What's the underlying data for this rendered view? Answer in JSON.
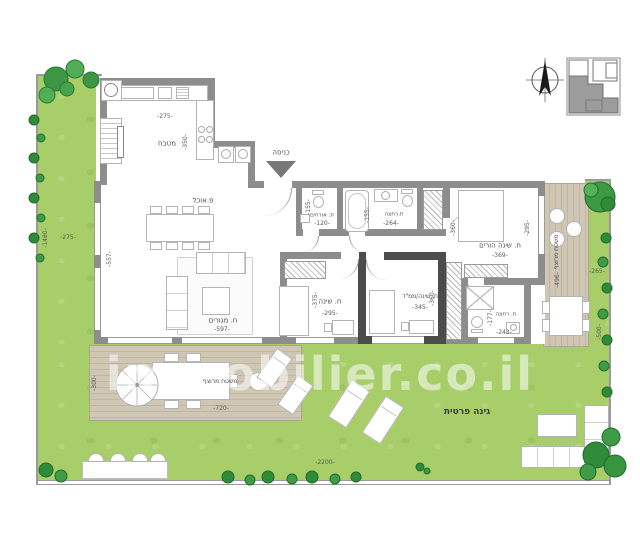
{
  "watermark": "immobilier.co.il",
  "rooms": {
    "kitchen": {
      "name": "מטבח",
      "width": "-275-",
      "depth": "-350-"
    },
    "dining": {
      "name": "פ.אוכל"
    },
    "living": {
      "name": "ח. מגורים",
      "width": "-597-",
      "depth": "-557-"
    },
    "entrance": {
      "name": "כניסה"
    },
    "guest_wc": {
      "name": "ת. אורחים",
      "width": "-120-",
      "depth": "-155-"
    },
    "bathroom": {
      "name": "ת.רחצה",
      "width": "-264-",
      "depth": "-155-"
    },
    "bedroom": {
      "name": "ח. שינה",
      "width": "-295-",
      "depth": "-375-"
    },
    "safe_room": {
      "name": "ח. שינה/ממ\"ד",
      "width": "-345-",
      "depth": "-360-"
    },
    "parents_bedroom": {
      "name": "ח. שינה הורים",
      "width": "-369-",
      "depth_left": "-360-",
      "depth_right": "-295-"
    },
    "parents_bathroom": {
      "name": "ת. רחצה",
      "width": "-243-",
      "depth": "-177-"
    }
  },
  "outdoor": {
    "deck_right": {
      "name": "משטח מרוצף",
      "depth": "-496-"
    },
    "deck_left": {
      "name": "משטח מרוצף",
      "width": "-720-",
      "depth": "-300-"
    },
    "garden": {
      "name": "גינה פרטית",
      "width": "-2200-"
    },
    "garden_left": {
      "width": "-275-",
      "depth": "-1480-"
    },
    "garden_right": {
      "width": "-265-",
      "depth": "-500-"
    }
  }
}
